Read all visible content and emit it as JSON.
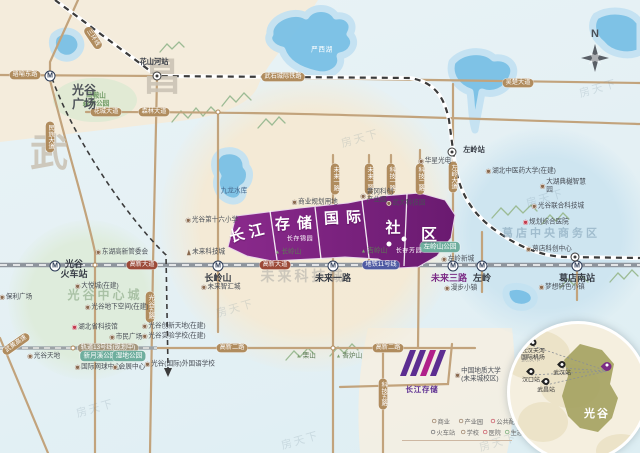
{
  "title": "长江存储国际社区 区位图",
  "compass_label": "N",
  "watermark": {
    "text": "房天下",
    "spots": [
      [
        360,
        138
      ],
      [
        545,
        198
      ],
      [
        235,
        308
      ],
      [
        95,
        408
      ],
      [
        498,
        442
      ],
      [
        598,
        88
      ],
      [
        300,
        440
      ]
    ]
  },
  "districts": [
    {
      "t": "昌",
      "x": 143,
      "y": 57,
      "fs": 38
    },
    {
      "t": "武",
      "x": 30,
      "y": 133,
      "fs": 38
    }
  ],
  "plaza_label": "光谷\n广场",
  "area_labels": [
    {
      "t": "光谷中心城",
      "x": 105,
      "y": 296,
      "color": "rgba(125,158,120,.55)",
      "fs": 12
    },
    {
      "t": "未来科技城",
      "x": 303,
      "y": 276,
      "color": "rgba(150,150,150,.42)",
      "fs": 14
    },
    {
      "t": "葛店中央商务区",
      "x": 551,
      "y": 234,
      "color": "rgba(115,150,172,.5)",
      "fs": 11
    }
  ],
  "banner": {
    "segments": [
      {
        "t": "长江",
        "x": 249,
        "y": 232,
        "rot": -14,
        "fs": 15,
        "ls": 5
      },
      {
        "t": "存储",
        "x": 297,
        "y": 223,
        "rot": -3,
        "fs": 15,
        "ls": 7
      },
      {
        "t": "国际",
        "x": 346,
        "y": 217,
        "rot": -3,
        "fs": 15,
        "ls": 7
      },
      {
        "t": "社",
        "x": 393,
        "y": 227,
        "rot": 0,
        "fs": 15,
        "ls": 0
      },
      {
        "t": "区",
        "x": 429,
        "y": 233,
        "rot": 0,
        "fs": 16,
        "ls": 0
      }
    ],
    "subs": [
      {
        "t": "长存锦园",
        "x": 300,
        "y": 238
      },
      {
        "t": "长存芳园",
        "x": 409,
        "y": 250
      }
    ],
    "dots": [
      [
        389,
        244
      ],
      [
        404,
        239
      ]
    ]
  },
  "pills": [
    {
      "t": "珞喻东路",
      "x": 25,
      "y": 75
    },
    {
      "t": "三环线",
      "x": 93,
      "y": 38,
      "rot": 56
    },
    {
      "t": "花城大道",
      "x": 106,
      "y": 112
    },
    {
      "t": "森林大道",
      "x": 154,
      "y": 112
    },
    {
      "t": "武石城际铁路",
      "x": 283,
      "y": 77
    },
    {
      "t": "吴楚大道",
      "x": 518,
      "y": 83
    },
    {
      "t": "民族大道",
      "x": 50,
      "y": 137,
      "v": true
    },
    {
      "t": "光谷五路",
      "x": 150,
      "y": 307,
      "v": true
    },
    {
      "t": "未来一路",
      "x": 335,
      "y": 179,
      "v": true
    },
    {
      "t": "未来二路",
      "x": 369,
      "y": 179,
      "v": true
    },
    {
      "t": "科技一路",
      "x": 391,
      "y": 179,
      "v": true
    },
    {
      "t": "科技二路",
      "x": 420,
      "y": 179,
      "v": true
    },
    {
      "t": "左岭大道",
      "x": 453,
      "y": 177,
      "v": true
    },
    {
      "t": "高新二路",
      "x": 232,
      "y": 348
    },
    {
      "t": "高新二路",
      "x": 388,
      "y": 348
    },
    {
      "t": "科技五路",
      "x": 383,
      "y": 394,
      "v": true
    },
    {
      "t": "武黄高速",
      "x": 16,
      "y": 344,
      "rot": -35
    },
    {
      "t": "高新大道",
      "x": 142,
      "y": 265,
      "s": "maroon"
    },
    {
      "t": "高新大道",
      "x": 275,
      "y": 265,
      "s": "maroon"
    },
    {
      "t": "地铁11号线",
      "x": 381,
      "y": 265,
      "s": "blue"
    },
    {
      "t": "轨道13号线(规划中)",
      "x": 108,
      "y": 348,
      "s": "plan"
    }
  ],
  "metro_stations": [
    {
      "name": "光谷\n火车站",
      "x": 55,
      "y": 266,
      "lx": 74,
      "ly": 260
    },
    {
      "name": "",
      "x": 50,
      "y": 76,
      "lx": 0,
      "ly": 0
    },
    {
      "name": "长岭山",
      "x": 218,
      "y": 266,
      "lx": 218,
      "ly": 274
    },
    {
      "name": "未来一路",
      "x": 333,
      "y": 266,
      "lx": 333,
      "ly": 274
    },
    {
      "name": "未来三路",
      "x": 453,
      "y": 266,
      "lx": 449,
      "ly": 274,
      "cls": "purple"
    },
    {
      "name": "左岭",
      "x": 482,
      "y": 266,
      "lx": 482,
      "ly": 274
    },
    {
      "name": "葛店南站",
      "x": 577,
      "y": 266,
      "lx": 577,
      "ly": 274
    }
  ],
  "rail_stations": [
    {
      "name": "花山河站",
      "x": 157,
      "y": 76,
      "lx": 154,
      "ly": 58
    },
    {
      "name": "左岭站",
      "x": 452,
      "y": 152,
      "lx": 474,
      "ly": 146
    },
    {
      "name": "",
      "x": 575,
      "y": 257,
      "lx": 0,
      "ly": 0
    }
  ],
  "pois": [
    {
      "t": "东湖高新管委会",
      "x": 122,
      "y": 252,
      "k": "dot"
    },
    {
      "t": "保利广场",
      "x": 16,
      "y": 297,
      "k": "dot"
    },
    {
      "t": "大悦城(在建)",
      "x": 97,
      "y": 286,
      "k": "dot"
    },
    {
      "t": "光谷地下空间(在建)",
      "x": 117,
      "y": 307,
      "k": "dot"
    },
    {
      "t": "湖北省科技馆",
      "x": 95,
      "y": 327,
      "k": "red"
    },
    {
      "t": "市民广场",
      "x": 126,
      "y": 337,
      "k": "dot"
    },
    {
      "t": "光谷天地",
      "x": 44,
      "y": 356,
      "k": "dot"
    },
    {
      "t": "新月溪公园",
      "x": 100,
      "y": 356,
      "k": "park"
    },
    {
      "t": "湿地公园",
      "x": 129,
      "y": 356,
      "k": "park"
    },
    {
      "t": "国际网球中心",
      "x": 98,
      "y": 367,
      "k": "dot"
    },
    {
      "t": "会展中心",
      "x": 129,
      "y": 367,
      "k": "dot"
    },
    {
      "t": "马鞍山\n森林公园",
      "x": 96,
      "y": 100,
      "k": "green2"
    },
    {
      "t": "光谷第十六小学",
      "x": 212,
      "y": 220,
      "k": "dot"
    },
    {
      "t": "未来科技城",
      "x": 206,
      "y": 252,
      "k": "tower"
    },
    {
      "t": "商业规划用地",
      "x": 315,
      "y": 202,
      "k": "dot"
    },
    {
      "t": "未来智汇城",
      "x": 221,
      "y": 287,
      "k": "dot"
    },
    {
      "t": "光谷创新天地(在建)",
      "x": 174,
      "y": 326,
      "k": "dot"
    },
    {
      "t": "光谷实验学校(在建)",
      "x": 174,
      "y": 336,
      "k": "dot"
    },
    {
      "t": "光谷(国际)外国语学校",
      "x": 180,
      "y": 364,
      "k": "dot"
    },
    {
      "t": "严西湖",
      "x": 322,
      "y": 50,
      "k": "lakeW"
    },
    {
      "t": "九龙水库",
      "x": 234,
      "y": 191,
      "k": "lakeD"
    },
    {
      "t": "长岭山",
      "x": 288,
      "y": 252,
      "k": "mtn"
    },
    {
      "t": "吉岭山",
      "x": 374,
      "y": 251,
      "k": "mtn"
    },
    {
      "t": "栗山",
      "x": 306,
      "y": 356,
      "k": "mtn"
    },
    {
      "t": "香炉山",
      "x": 349,
      "y": 356,
      "k": "mtn"
    },
    {
      "t": "华星光电",
      "x": 435,
      "y": 161,
      "k": "dot"
    },
    {
      "t": "黄冈科创\n产业园",
      "x": 377,
      "y": 196,
      "k": "dot"
    },
    {
      "t": "武大科技园",
      "x": 406,
      "y": 203,
      "k": "dot"
    },
    {
      "t": "左岭山公园",
      "x": 440,
      "y": 247,
      "k": "park"
    },
    {
      "t": "左岭新城",
      "x": 458,
      "y": 259,
      "k": "dot"
    },
    {
      "t": "湖北中医药大学(在建)",
      "x": 521,
      "y": 171,
      "k": "dot"
    },
    {
      "t": "大湖典樾智慧园",
      "x": 565,
      "y": 186,
      "k": "dot"
    },
    {
      "t": "光谷联合科技城",
      "x": 558,
      "y": 206,
      "k": "dot"
    },
    {
      "t": "规划综合医院",
      "x": 546,
      "y": 222,
      "k": "red"
    },
    {
      "t": "葛店科创中心",
      "x": 549,
      "y": 249,
      "k": "dot"
    },
    {
      "t": "漫步小镇",
      "x": 461,
      "y": 288,
      "k": "dot"
    },
    {
      "t": "梦想特色小镇",
      "x": 562,
      "y": 287,
      "k": "dot"
    },
    {
      "t": "中国地质大学\n(未来城校区)",
      "x": 478,
      "y": 375,
      "k": "dot"
    }
  ],
  "legend": {
    "items": [
      {
        "t": "商业",
        "x": 441,
        "y": 421,
        "c": "#8a6a4f"
      },
      {
        "t": "产业园",
        "x": 471,
        "y": 421,
        "c": "#8a6a4f"
      },
      {
        "t": "公共配套",
        "x": 506,
        "y": 421,
        "c": "#c23b4e"
      },
      {
        "t": "火车站",
        "x": 443,
        "y": 432,
        "c": "#55585e"
      },
      {
        "t": "学校",
        "x": 470,
        "y": 432,
        "c": "#8a6a4f"
      },
      {
        "t": "医院",
        "x": 492,
        "y": 432,
        "c": "#c23b4e"
      },
      {
        "t": "生态",
        "x": 514,
        "y": 432,
        "c": "#5f9e62"
      }
    ]
  },
  "logo": {
    "text": "长江存储"
  },
  "inset": {
    "city": "武汉市",
    "region": "光谷",
    "pins": [
      {
        "t": "武汉天河\n国际机场",
        "x": 23,
        "y": 22
      },
      {
        "t": "武汉站",
        "x": 52,
        "y": 44
      },
      {
        "t": "汉口站",
        "x": 21,
        "y": 51
      },
      {
        "t": "武昌站",
        "x": 36,
        "y": 61
      }
    ],
    "project_pin": [
      97,
      47
    ]
  },
  "colors": {
    "banner_purple": "#7c2080",
    "metro_blue": "#4f5ba3",
    "road_tan": "#b08c5e",
    "road_maroon": "#9c4a38",
    "lake_blue": "#79c0e6",
    "guanggu_olive": "#a8a465"
  }
}
